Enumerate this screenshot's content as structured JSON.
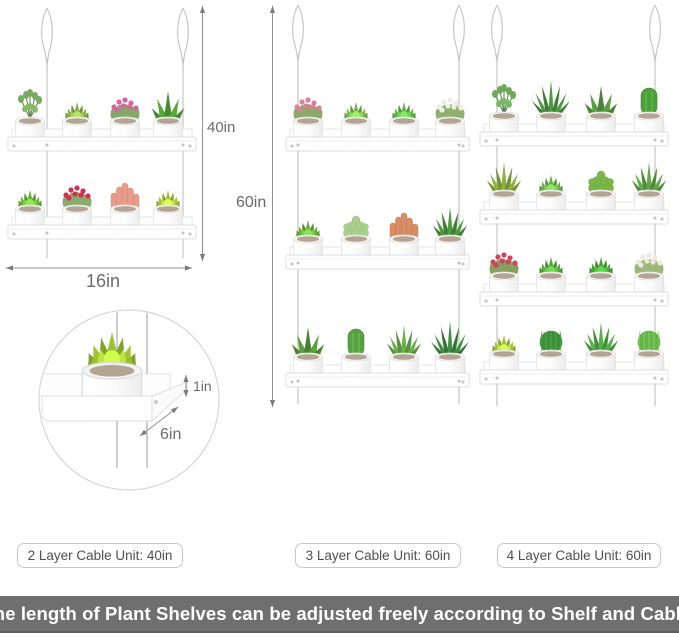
{
  "banner": {
    "text": "The length of Plant Shelves can be adjusted freely according to Shelf and Cable.",
    "bg": "#6f6f6f",
    "color": "#ffffff"
  },
  "unit_labels": [
    {
      "text": "2 Layer Cable Unit: 40in"
    },
    {
      "text": "3 Layer Cable Unit: 60in"
    },
    {
      "text": "4 Layer Cable Unit: 60in"
    }
  ],
  "dimensions": {
    "left_height": "40in",
    "left_width": "16in",
    "middle_height": "60in",
    "detail_thickness": "1in",
    "detail_depth": "6in"
  },
  "units": [
    {
      "name": "2-layer",
      "layers": 2,
      "plants": [
        [
          {
            "t": "leafy",
            "c": "#79aa5e"
          },
          {
            "t": "rosette",
            "c": "#8cae4c"
          },
          {
            "t": "flowers",
            "c": "#84a86b",
            "a": "#d7669c"
          },
          {
            "t": "aloe",
            "c": "#58a83d"
          }
        ],
        [
          {
            "t": "rosette",
            "c": "#6fb33c"
          },
          {
            "t": "flowers",
            "c": "#8aab6d",
            "a": "#cc3350"
          },
          {
            "t": "coral",
            "c": "#e89d8a"
          },
          {
            "t": "rosette",
            "c": "#a9c33d"
          }
        ]
      ]
    },
    {
      "name": "3-layer",
      "layers": 3,
      "plants": [
        [
          {
            "t": "flowers",
            "c": "#8ba96b",
            "a": "#d9809a"
          },
          {
            "t": "rosette",
            "c": "#79b851"
          },
          {
            "t": "rosette",
            "c": "#63b44a"
          },
          {
            "t": "flowers",
            "c": "#90b070",
            "a": "#efeee4"
          }
        ],
        [
          {
            "t": "rosette",
            "c": "#6cae3f"
          },
          {
            "t": "fuzzy",
            "c": "#a8cf8e"
          },
          {
            "t": "coral",
            "c": "#d98d66"
          },
          {
            "t": "spiky",
            "c": "#4f9a3e"
          }
        ],
        [
          {
            "t": "aloe",
            "c": "#5c9e3d"
          },
          {
            "t": "cactus",
            "c": "#58a044"
          },
          {
            "t": "spiky",
            "c": "#6ab04c"
          },
          {
            "t": "fern",
            "c": "#3f8e41"
          }
        ]
      ]
    },
    {
      "name": "4-layer",
      "layers": 4,
      "plants": [
        [
          {
            "t": "leafy",
            "c": "#6fa85a"
          },
          {
            "t": "fern",
            "c": "#4e9a43"
          },
          {
            "t": "aloe",
            "c": "#5aa046"
          },
          {
            "t": "cactus",
            "c": "#4f9e3c"
          }
        ],
        [
          {
            "t": "spiky",
            "c": "#8fb13f"
          },
          {
            "t": "rosette",
            "c": "#6db04b"
          },
          {
            "t": "fuzzy",
            "c": "#7ab648"
          },
          {
            "t": "spiky",
            "c": "#62a949"
          }
        ],
        [
          {
            "t": "flowers",
            "c": "#87a060",
            "a": "#c9485e"
          },
          {
            "t": "rosette",
            "c": "#55a83f"
          },
          {
            "t": "rosette",
            "c": "#49a53b"
          },
          {
            "t": "flowers",
            "c": "#9cb87a",
            "a": "#ece9dc"
          }
        ],
        [
          {
            "t": "rosette",
            "c": "#a5c23f"
          },
          {
            "t": "ball",
            "c": "#3f8f3a"
          },
          {
            "t": "spiky",
            "c": "#55b04a"
          },
          {
            "t": "ball",
            "c": "#67b34c"
          }
        ]
      ]
    }
  ],
  "detail": {
    "plant": {
      "t": "rosette",
      "c": "#9fc437"
    }
  }
}
